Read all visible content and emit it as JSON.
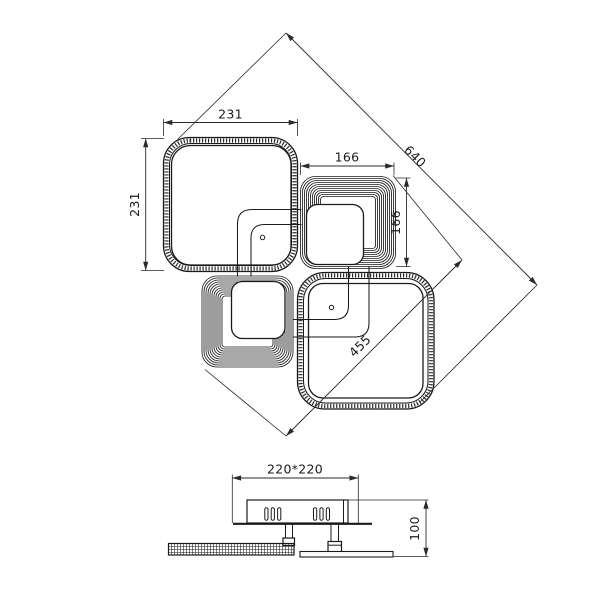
{
  "colors": {
    "line": "#1a1a1a",
    "background": "#ffffff"
  },
  "top_view": {
    "large_square_left": {
      "width_label": "231",
      "height_label": "231"
    },
    "small_square_right": {
      "width_label": "166",
      "height_label": "166"
    },
    "diagonal_total_label": "640",
    "diagonal_inner_label": "455"
  },
  "side_view": {
    "canopy_width_label": "220*220",
    "height_label": "100"
  }
}
